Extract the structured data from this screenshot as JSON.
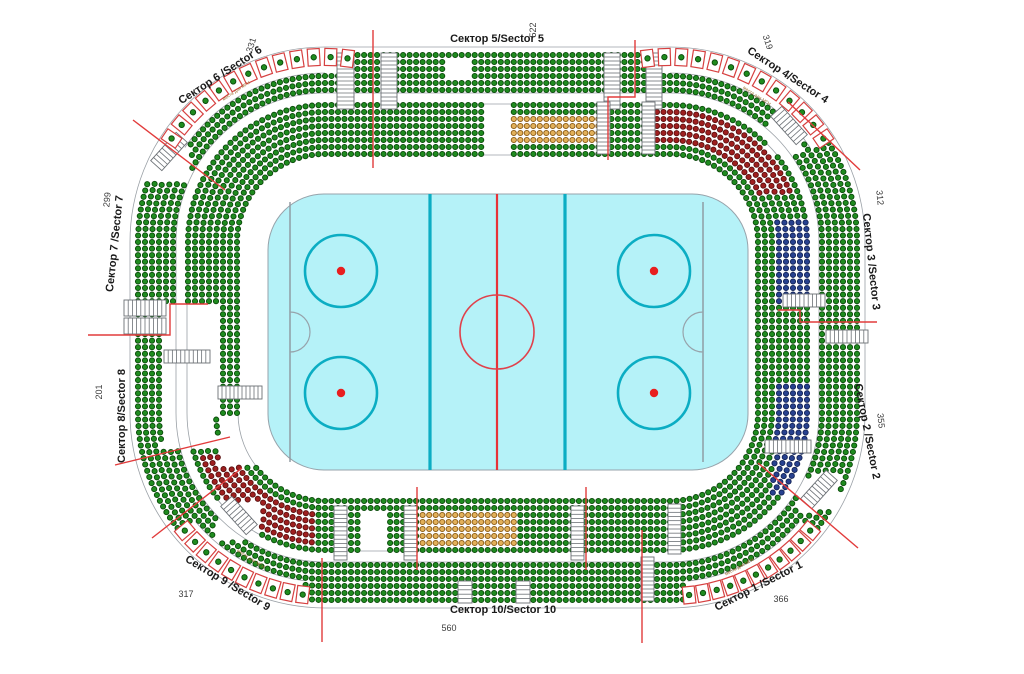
{
  "canvas": {
    "w": 1024,
    "h": 674,
    "bg": "#ffffff"
  },
  "colors": {
    "seat_green": {
      "fill": "#1f8b1f",
      "stroke": "#0a4a0a"
    },
    "seat_maroon": {
      "fill": "#9e1f1f",
      "stroke": "#5c1010"
    },
    "seat_navy": {
      "fill": "#27418f",
      "stroke": "#142457"
    },
    "seat_orange": {
      "fill": "#e2b05a",
      "stroke": "#8a5a14"
    },
    "divider_red": "#e23b3b",
    "outline_gray": "#9aa0a6",
    "stair_stroke": "#6b7075",
    "box_red": "#d64040",
    "label_dark": "#1a1a1a",
    "number_gray": "#3c3c3c",
    "note_gray": "#9a6a2a"
  },
  "rink": {
    "x": 268,
    "y": 194,
    "w": 480,
    "h": 276,
    "rx": 56,
    "ice": "#b5f2f8",
    "border": "#97a3ab",
    "center_line": {
      "x": 497,
      "color": "#e63238",
      "width": 2.2
    },
    "blue_lines": {
      "xs": [
        430,
        565
      ],
      "color": "#0badc3",
      "width": 3.2
    },
    "goal_lines": {
      "xs": [
        290,
        703
      ],
      "color": "#8d979e",
      "width": 1.4
    },
    "center_circle": {
      "cx": 497,
      "cy": 332,
      "r": 37,
      "color": "#e0414b",
      "width": 1.6
    },
    "faceoff_circles": {
      "centers": [
        [
          341,
          271
        ],
        [
          341,
          393
        ],
        [
          654,
          271
        ],
        [
          654,
          393
        ]
      ],
      "r": 36,
      "color": "#0badc3",
      "width": 2.6
    },
    "faceoff_dots": {
      "r": 4.2,
      "color": "#e81f1f"
    },
    "crease": {
      "r": 20,
      "color": "#97a3ab"
    }
  },
  "arena": {
    "outer": {
      "x": 130,
      "y": 47,
      "w": 735,
      "h": 561,
      "r": 195
    },
    "ring_insets": [
      8,
      15,
      22,
      29,
      36,
      43,
      58,
      65,
      72,
      79,
      86,
      93,
      100,
      107
    ],
    "dot_r": 2.6,
    "spacing": 6.5,
    "outline_insets": [
      0,
      46,
      57,
      108
    ],
    "box_row_inner_radius": 169,
    "box_gap_max_inset": 26,
    "top_straight_box_gap": {
      "x_left": 353,
      "x_right": 645
    }
  },
  "zones": [
    {
      "name": "vip-orange-top",
      "x": 512,
      "y": 113,
      "w": 88,
      "h": 31,
      "iMin": 66,
      "iMax": 96,
      "color": "seat_orange"
    },
    {
      "name": "vip-orange-bottom",
      "x": 417,
      "y": 512,
      "w": 101,
      "h": 38,
      "iMin": 60,
      "iMax": 96,
      "color": "seat_orange"
    },
    {
      "name": "reserved-maroon-tr",
      "x": 648,
      "y": 98,
      "w": 155,
      "h": 95,
      "iMin": 63,
      "iMax": 95,
      "color": "seat_maroon"
    },
    {
      "name": "reserved-maroon-bl",
      "x": 168,
      "y": 452,
      "w": 150,
      "h": 112,
      "iMin": 63,
      "iMax": 95,
      "color": "seat_maroon"
    },
    {
      "name": "vip-navy-right-upper",
      "x": 772,
      "y": 220,
      "w": 58,
      "h": 84,
      "iMin": 50,
      "iMax": 88,
      "color": "seat_navy"
    },
    {
      "name": "vip-navy-right-lower",
      "x": 772,
      "y": 383,
      "w": 58,
      "h": 110,
      "iMin": 50,
      "iMax": 88,
      "color": "seat_navy"
    }
  ],
  "gaps": [
    {
      "x": 486,
      "y": 100,
      "w": 26,
      "h": 62
    },
    {
      "x": 447,
      "y": 56,
      "w": 22,
      "h": 20
    },
    {
      "x": 162,
      "y": 302,
      "w": 54,
      "h": 146
    },
    {
      "x": 218,
      "y": 418,
      "w": 95,
      "h": 48
    },
    {
      "x": 362,
      "y": 512,
      "w": 28,
      "h": 38
    },
    {
      "x": 768,
      "y": 112,
      "w": 36,
      "h": 42
    },
    {
      "x": 796,
      "y": 476,
      "w": 44,
      "h": 36
    },
    {
      "x": 146,
      "y": 138,
      "w": 44,
      "h": 42
    },
    {
      "x": 216,
      "y": 500,
      "w": 44,
      "h": 40
    }
  ],
  "stairs": [
    {
      "x": 337,
      "y": 53,
      "w": 17,
      "h": 56,
      "dir": "v"
    },
    {
      "x": 381,
      "y": 53,
      "w": 16,
      "h": 56,
      "dir": "v"
    },
    {
      "x": 604,
      "y": 53,
      "w": 16,
      "h": 56,
      "dir": "v"
    },
    {
      "x": 646,
      "y": 53,
      "w": 16,
      "h": 56,
      "dir": "v"
    },
    {
      "x": 597,
      "y": 102,
      "w": 13,
      "h": 52,
      "dir": "v"
    },
    {
      "x": 642,
      "y": 102,
      "w": 13,
      "h": 52,
      "dir": "v"
    },
    {
      "x": 334,
      "y": 506,
      "w": 13,
      "h": 54,
      "dir": "v"
    },
    {
      "x": 404,
      "y": 506,
      "w": 13,
      "h": 54,
      "dir": "v"
    },
    {
      "x": 571,
      "y": 506,
      "w": 13,
      "h": 54,
      "dir": "v"
    },
    {
      "x": 668,
      "y": 504,
      "w": 13,
      "h": 50,
      "dir": "v"
    },
    {
      "x": 641,
      "y": 557,
      "w": 13,
      "h": 44,
      "dir": "v"
    },
    {
      "x": 458,
      "y": 581,
      "w": 14,
      "h": 22,
      "dir": "v"
    },
    {
      "x": 516,
      "y": 581,
      "w": 14,
      "h": 22,
      "dir": "v"
    },
    {
      "x": 124,
      "y": 300,
      "w": 42,
      "h": 16,
      "dir": "h"
    },
    {
      "x": 124,
      "y": 318,
      "w": 42,
      "h": 16,
      "dir": "h"
    },
    {
      "x": 218,
      "y": 386,
      "w": 44,
      "h": 13,
      "dir": "h"
    },
    {
      "x": 164,
      "y": 350,
      "w": 46,
      "h": 13,
      "dir": "h"
    },
    {
      "x": 783,
      "y": 294,
      "w": 42,
      "h": 13,
      "dir": "h"
    },
    {
      "x": 826,
      "y": 330,
      "w": 42,
      "h": 13,
      "dir": "h"
    },
    {
      "x": 765,
      "y": 440,
      "w": 46,
      "h": 13,
      "dir": "h"
    },
    {
      "x": 150,
      "y": 144,
      "w": 38,
      "h": 15,
      "dir": "h",
      "rot": -48
    },
    {
      "x": 770,
      "y": 118,
      "w": 38,
      "h": 15,
      "dir": "h",
      "rot": 48
    },
    {
      "x": 220,
      "y": 508,
      "w": 38,
      "h": 15,
      "dir": "h",
      "rot": 48
    },
    {
      "x": 800,
      "y": 482,
      "w": 38,
      "h": 15,
      "dir": "h",
      "rot": -48
    }
  ],
  "dividers": [
    [
      [
        373,
        30
      ],
      [
        373,
        168
      ]
    ],
    [
      [
        635,
        40
      ],
      [
        635,
        97
      ],
      [
        608,
        97
      ],
      [
        608,
        160
      ]
    ],
    [
      [
        133,
        120
      ],
      [
        225,
        190
      ]
    ],
    [
      [
        88,
        335
      ],
      [
        170,
        335
      ],
      [
        170,
        304
      ],
      [
        208,
        304
      ]
    ],
    [
      [
        115,
        465
      ],
      [
        230,
        437
      ]
    ],
    [
      [
        152,
        538
      ],
      [
        242,
        468
      ]
    ],
    [
      [
        322,
        558
      ],
      [
        322,
        642
      ]
    ],
    [
      [
        417,
        487
      ],
      [
        417,
        570
      ]
    ],
    [
      [
        586,
        487
      ],
      [
        586,
        570
      ]
    ],
    [
      [
        642,
        530
      ],
      [
        642,
        643
      ]
    ],
    [
      [
        788,
        102
      ],
      [
        860,
        170
      ]
    ],
    [
      [
        778,
        310
      ],
      [
        800,
        310
      ],
      [
        800,
        322
      ],
      [
        877,
        322
      ]
    ],
    [
      [
        758,
        463
      ],
      [
        858,
        548
      ]
    ]
  ],
  "box_arcs": [
    {
      "corner": "tl",
      "r": 185,
      "a0": 214,
      "a1": 277,
      "n": 13
    },
    {
      "corner": "tr",
      "r": 185,
      "a0": 263,
      "a1": 326,
      "n": 13
    },
    {
      "corner": "bl",
      "r": 183,
      "a0": 97,
      "a1": 140,
      "n": 10
    },
    {
      "corner": "br",
      "r": 183,
      "a0": 40,
      "a1": 84,
      "n": 11
    }
  ],
  "box_gap_ranges": [
    {
      "corner": "tl",
      "a0": 214,
      "a1": 270
    },
    {
      "corner": "tr",
      "a0": 270,
      "a1": 326
    },
    {
      "corner": "bl",
      "a0": 97,
      "a1": 140
    },
    {
      "corner": "br",
      "a0": 40,
      "a1": 84
    }
  ],
  "sectors": [
    {
      "id": "5",
      "label": "Сектор 5/Sector 5",
      "capacity": "522",
      "label_pos": {
        "x": 497,
        "y": 42,
        "rot": 0
      },
      "cap_pos": {
        "x": 536,
        "y": 30,
        "rot": -90
      }
    },
    {
      "id": "6",
      "label": "Сектор 6 /Sector 6",
      "capacity": "331",
      "label_pos": {
        "x": 222,
        "y": 78,
        "rot": -33
      },
      "cap_pos": {
        "x": 254,
        "y": 46,
        "rot": -72
      }
    },
    {
      "id": "4",
      "label": "Сектор 4/Sector 4",
      "capacity": "319",
      "label_pos": {
        "x": 786,
        "y": 78,
        "rot": 33
      },
      "cap_pos": {
        "x": 765,
        "y": 43,
        "rot": 72
      }
    },
    {
      "id": "7",
      "label": "Сектор 7 /Sector 7",
      "capacity": "299",
      "label_pos": {
        "x": 118,
        "y": 244,
        "rot": -84
      },
      "cap_pos": {
        "x": 110,
        "y": 200,
        "rot": -84
      }
    },
    {
      "id": "3",
      "label": "Сектор 3 /Sector 3",
      "capacity": "312",
      "label_pos": {
        "x": 868,
        "y": 262,
        "rot": 84
      },
      "cap_pos": {
        "x": 877,
        "y": 198,
        "rot": 84
      }
    },
    {
      "id": "8",
      "label": "Сектор 8/Sector 8",
      "capacity": "201",
      "label_pos": {
        "x": 125,
        "y": 416,
        "rot": -90
      },
      "cap_pos": {
        "x": 102,
        "y": 392,
        "rot": -90
      }
    },
    {
      "id": "2",
      "label": "Сектор 2 /Sector 2",
      "capacity": "355",
      "label_pos": {
        "x": 864,
        "y": 432,
        "rot": 79
      },
      "cap_pos": {
        "x": 878,
        "y": 421,
        "rot": 84
      }
    },
    {
      "id": "9",
      "label": "Сектор 9 /Sector 9",
      "capacity": "317",
      "label_pos": {
        "x": 226,
        "y": 586,
        "rot": 31
      },
      "cap_pos": {
        "x": 186,
        "y": 597,
        "rot": 0
      }
    },
    {
      "id": "1",
      "label": "Сектор 1 /Sector 1",
      "capacity": "366",
      "label_pos": {
        "x": 760,
        "y": 589,
        "rot": -27
      },
      "cap_pos": {
        "x": 781,
        "y": 602,
        "rot": 0
      }
    },
    {
      "id": "10",
      "label": "Сектор 10/Sector 10",
      "capacity": "560",
      "label_pos": {
        "x": 503,
        "y": 613,
        "rot": 0
      },
      "cap_pos": {
        "x": 449,
        "y": 631,
        "rot": 0
      }
    }
  ],
  "accessible_label": "места для МГН",
  "accessible_notes": [
    {
      "x": 237,
      "y": 92,
      "rot": -33
    },
    {
      "x": 756,
      "y": 97,
      "rot": 33
    },
    {
      "x": 250,
      "y": 560,
      "rot": 33
    },
    {
      "x": 740,
      "y": 568,
      "rot": -28
    }
  ]
}
